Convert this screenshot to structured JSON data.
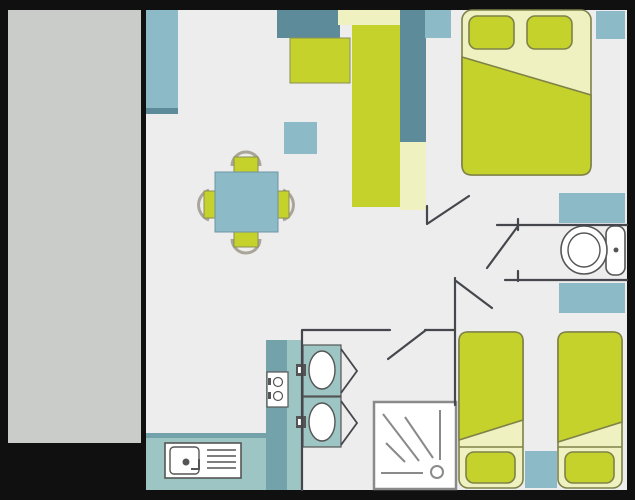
{
  "colors": {
    "frame": "#101010",
    "terrace": "#c9ccc8",
    "floor": "#ededee",
    "teal": "#8cbbc7",
    "slate": "#5d8b99",
    "counter": "#9dc5c4",
    "counter_dark": "#73a2ab",
    "green": "#c6d22c",
    "cream": "#f0f1c1",
    "bed_outline": "#7e8248",
    "wall": "#45474d",
    "line": "#8a8a8a",
    "detail": "#555555",
    "chair_arc": "#a9a598",
    "white": "#ffffff"
  },
  "scene": {
    "type": "floor-plan",
    "rooms": [
      "terrace",
      "living-kitchen",
      "master-bedroom",
      "wc",
      "shower-room",
      "twin-bedroom"
    ],
    "furniture_icons": [
      "terrace-deck",
      "wall-cabinet",
      "dining-table",
      "dining-chair",
      "stool",
      "overhead-unit",
      "kitchen-block",
      "wardrobe-column",
      "tall-cabinet",
      "window-shelf",
      "double-bed",
      "pillow",
      "kitchen-counter",
      "stove",
      "kitchen-sink",
      "washbasin",
      "cabinet-door-chevron",
      "shower-tray",
      "toilet",
      "bathroom-cabinet",
      "twin-bed",
      "nightstand",
      "door-swing"
    ]
  }
}
